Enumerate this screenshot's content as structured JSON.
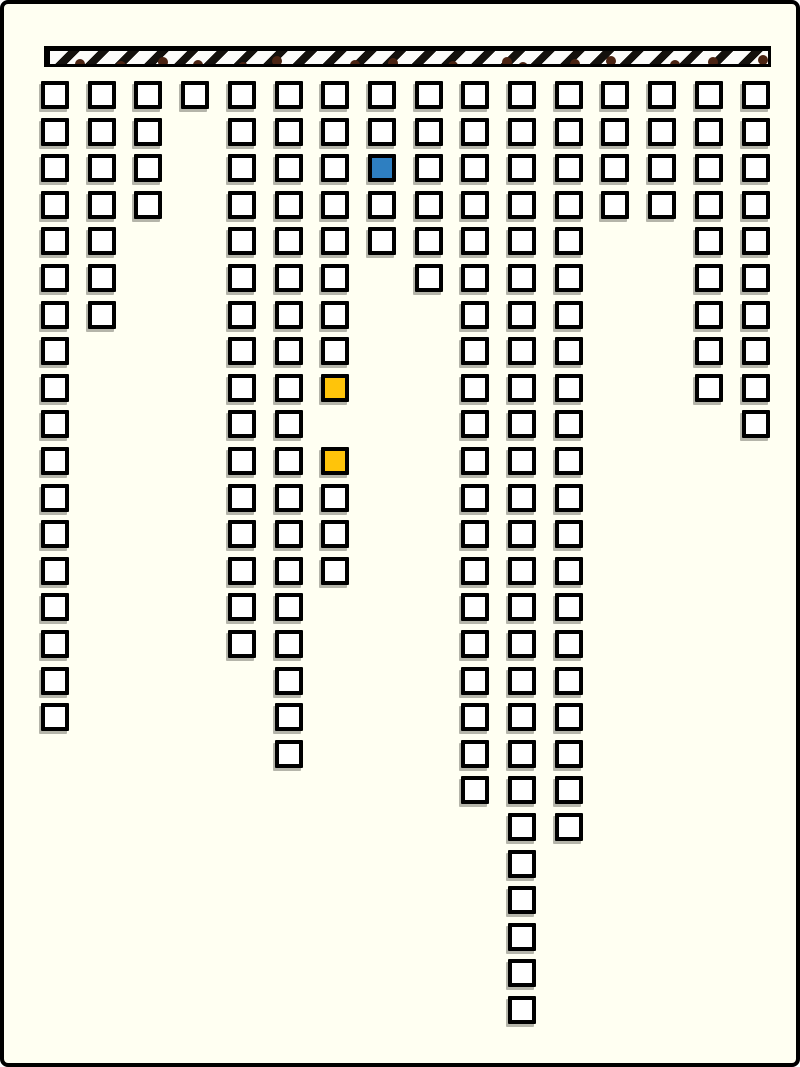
{
  "scene": {
    "background_color": "#FFFFF2",
    "frame_border_color": "#000000"
  },
  "hatched_bar": {
    "left": 40,
    "top": 42,
    "width": 727,
    "height": 21,
    "stripe_dark": "#14110D",
    "stripe_light": "#FCFCFA",
    "chip_color": "#4B2412",
    "chips": [
      {
        "x": 25,
        "y": 8
      },
      {
        "x": 66,
        "y": 10
      },
      {
        "x": 108,
        "y": 6
      },
      {
        "x": 143,
        "y": 9
      },
      {
        "x": 188,
        "y": 11
      },
      {
        "x": 222,
        "y": 5
      },
      {
        "x": 300,
        "y": 9
      },
      {
        "x": 338,
        "y": 7
      },
      {
        "x": 398,
        "y": 10
      },
      {
        "x": 452,
        "y": 6
      },
      {
        "x": 468,
        "y": 11
      },
      {
        "x": 520,
        "y": 8
      },
      {
        "x": 556,
        "y": 5
      },
      {
        "x": 620,
        "y": 9
      },
      {
        "x": 658,
        "y": 6
      },
      {
        "x": 708,
        "y": 4
      }
    ]
  },
  "squares": {
    "default_fill": "#FFFFFF",
    "border_color": "#000000",
    "highlight_blue": "#2E7FC1",
    "highlight_yellow": "#FFC40A",
    "columns": [
      {
        "col": 1,
        "rows": [
          1,
          2,
          3,
          4,
          5,
          6,
          7,
          8,
          9,
          10,
          11,
          12,
          13,
          14,
          15,
          16,
          17,
          18
        ],
        "highlights": {}
      },
      {
        "col": 2,
        "rows": [
          1,
          2,
          3,
          4,
          5,
          6,
          7
        ],
        "highlights": {}
      },
      {
        "col": 3,
        "rows": [
          1,
          2,
          3,
          4
        ],
        "highlights": {}
      },
      {
        "col": 4,
        "rows": [
          1
        ],
        "highlights": {}
      },
      {
        "col": 5,
        "rows": [
          1,
          2,
          3,
          4,
          5,
          6,
          7,
          8,
          9,
          10,
          11,
          12,
          13,
          14,
          15,
          16
        ],
        "highlights": {}
      },
      {
        "col": 6,
        "rows": [
          1,
          2,
          3,
          4,
          5,
          6,
          7,
          8,
          9,
          10,
          11,
          12,
          13,
          14,
          15,
          16,
          17,
          18,
          19
        ],
        "highlights": {}
      },
      {
        "col": 7,
        "rows": [
          1,
          2,
          3,
          4,
          5,
          6,
          7,
          8,
          9,
          11,
          12,
          13,
          14
        ],
        "highlights": {
          "9": "yellow",
          "11": "yellow"
        }
      },
      {
        "col": 8,
        "rows": [
          1,
          2,
          3,
          4,
          5
        ],
        "highlights": {
          "3": "blue"
        }
      },
      {
        "col": 9,
        "rows": [
          1,
          2,
          3,
          4,
          5,
          6
        ],
        "highlights": {}
      },
      {
        "col": 10,
        "rows": [
          1,
          2,
          3,
          4,
          5,
          6,
          7,
          8,
          9,
          10,
          11,
          12,
          13,
          14,
          15,
          16,
          17,
          18,
          19,
          20
        ],
        "highlights": {}
      },
      {
        "col": 11,
        "rows": [
          1,
          2,
          3,
          4,
          5,
          6,
          7,
          8,
          9,
          10,
          11,
          12,
          13,
          14,
          15,
          16,
          17,
          18,
          19,
          20,
          21,
          22,
          23,
          24,
          25,
          26
        ],
        "highlights": {}
      },
      {
        "col": 12,
        "rows": [
          1,
          2,
          3,
          4,
          5,
          6,
          7,
          8,
          9,
          10,
          11,
          12,
          13,
          14,
          15,
          16,
          17,
          18,
          19,
          20,
          21
        ],
        "highlights": {}
      },
      {
        "col": 13,
        "rows": [
          1,
          2,
          3,
          4
        ],
        "highlights": {}
      },
      {
        "col": 14,
        "rows": [
          1,
          2,
          3,
          4
        ],
        "highlights": {}
      },
      {
        "col": 15,
        "rows": [
          1,
          2,
          3,
          4,
          5,
          6,
          7,
          8,
          9
        ],
        "highlights": {}
      },
      {
        "col": 16,
        "rows": [
          1,
          2,
          3,
          4,
          5,
          6,
          7,
          8,
          9,
          10
        ],
        "highlights": {}
      }
    ]
  }
}
